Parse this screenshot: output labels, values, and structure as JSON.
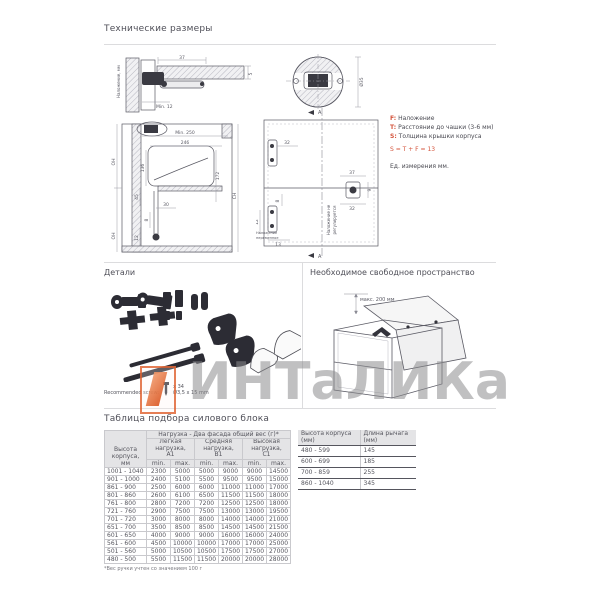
{
  "tech": {
    "title": "Технические размеры",
    "legend": {
      "f_key": "F:",
      "f_text": "Наложение",
      "t_key": "T:",
      "t_text": "Расстояние до чашки (3-6 мм)",
      "s_key": "S:",
      "s_text": "Толщина крышки корпуса",
      "formula": "S = T + F = 13",
      "units": "Ед. измерения мм."
    },
    "d1": {
      "dim_top": "37",
      "dim_right": "5",
      "dim_min": "Min. 12",
      "side_label": "Наложение, мм"
    },
    "d2": {
      "dim_min250": "Min. 250",
      "dim_246": "246",
      "dim_136": "136",
      "dim_172": "172",
      "dim_45": "45",
      "dim_30": "30",
      "dim_8": "8",
      "dim_12": "12",
      "oh": "OH",
      "ch": "CH"
    },
    "d3": {
      "dim_32": "32",
      "dim_37": "37",
      "dim_32b": "32",
      "dim_9": "9",
      "dim_8": "8",
      "dim_12": "12",
      "dim_13": "13",
      "section_a": "A",
      "vlabel_1": "Наложение не",
      "vlabel_2": "регулируется",
      "small_1": "Наложение",
      "small_2": "переменное"
    },
    "d4": {
      "dim_d35": "Ø35"
    }
  },
  "parts": {
    "title": "Детали",
    "note_prefix": "Recommended screw:",
    "screw_qty": "x 34",
    "screw_size": "Ø3,5 x 15 mm"
  },
  "space": {
    "title": "Необходимое свободное пространство",
    "dim": "макс. 200 мм"
  },
  "selection": {
    "title": "Таблица подбора силового блока",
    "load_header": "Нагрузка - Два фасада общий вес (г)*",
    "row_header": "Высота корпуса,\nмм",
    "groups": [
      {
        "label": "Легкая нагрузка,\nA1"
      },
      {
        "label": "Средняя нагрузка,\nB1"
      },
      {
        "label": "Высокая нагрузка,\nC1"
      }
    ],
    "min_label": "min.",
    "max_label": "max.",
    "rows": [
      {
        "h": "1001 - 1040",
        "v": [
          "2300",
          "5000",
          "5000",
          "9000",
          "9000",
          "14500"
        ]
      },
      {
        "h": "901 - 1000",
        "v": [
          "2400",
          "5100",
          "5500",
          "9500",
          "9500",
          "15000"
        ]
      },
      {
        "h": "861 - 900",
        "v": [
          "2500",
          "6000",
          "6000",
          "11000",
          "11000",
          "17000"
        ]
      },
      {
        "h": "801 - 860",
        "v": [
          "2600",
          "6100",
          "6500",
          "11500",
          "11500",
          "18000"
        ]
      },
      {
        "h": "761 - 800",
        "v": [
          "2800",
          "7200",
          "7200",
          "12500",
          "12500",
          "18000"
        ]
      },
      {
        "h": "721 - 760",
        "v": [
          "2900",
          "7500",
          "7500",
          "13000",
          "13000",
          "19500"
        ]
      },
      {
        "h": "701 - 720",
        "v": [
          "3000",
          "8000",
          "8000",
          "14000",
          "14000",
          "21000"
        ]
      },
      {
        "h": "651 - 700",
        "v": [
          "3500",
          "8500",
          "8500",
          "14500",
          "14500",
          "21500"
        ]
      },
      {
        "h": "601 - 650",
        "v": [
          "4000",
          "9000",
          "9000",
          "16000",
          "16000",
          "24000"
        ]
      },
      {
        "h": "561 - 600",
        "v": [
          "4500",
          "10000",
          "10000",
          "17000",
          "17000",
          "25000"
        ]
      },
      {
        "h": "501 - 560",
        "v": [
          "5000",
          "10500",
          "10500",
          "17500",
          "17500",
          "27000"
        ]
      },
      {
        "h": "480 - 500",
        "v": [
          "5500",
          "11500",
          "11500",
          "20000",
          "20000",
          "28000"
        ]
      }
    ],
    "footnote": "*Вес ручки учтен со значением 100 г",
    "arm_table": {
      "col1": "Высота корпуса\n(мм)",
      "col2": "Длина рычага\n(мм)",
      "rows": [
        {
          "h": "480 - 599",
          "l": "145"
        },
        {
          "h": "600 - 699",
          "l": "185"
        },
        {
          "h": "700 - 859",
          "l": "255"
        },
        {
          "h": "860 - 1040",
          "l": "345"
        }
      ]
    }
  },
  "watermark": {
    "text": "ИНТаЛИКа"
  }
}
